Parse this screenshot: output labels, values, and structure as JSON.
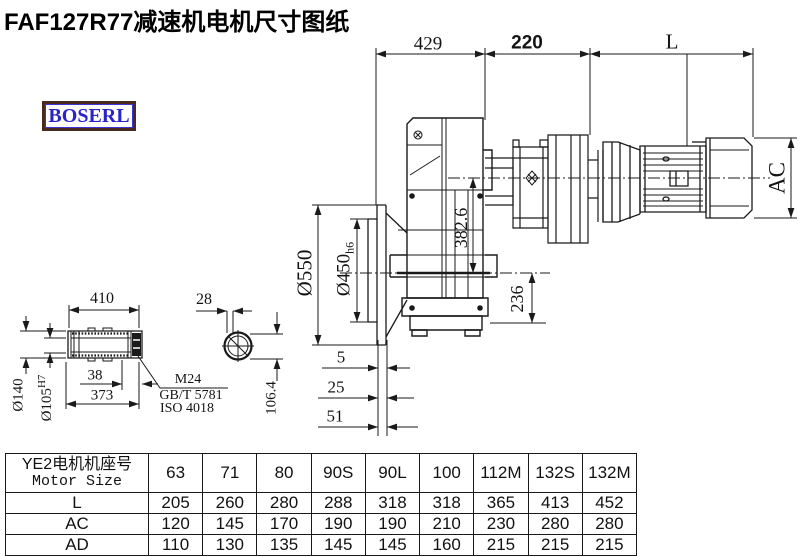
{
  "title": "FAF127R77减速机电机尺寸图纸",
  "logo": "BOSERL",
  "colors": {
    "line": "#1a1a1a",
    "background": "#ffffff",
    "logo_text": "#2a23c8",
    "logo_border": "#4a2a1e"
  },
  "dims": {
    "d429": "429",
    "d220": "220",
    "dL": "L",
    "ac": "AC",
    "dia550": "Ø550",
    "dia450": "Ø450",
    "dia450_tol": "h6",
    "v382": "382.6",
    "v236": "236",
    "b5": "5",
    "b25": "25",
    "b51": "51"
  },
  "shaft": {
    "d410": "410",
    "d28": "28",
    "dia140": "Ø140",
    "dia105": "Ø105",
    "dia105_tol": "H7",
    "d38": "38",
    "d373": "373",
    "callout": [
      "M24",
      "GB/T 5781",
      "ISO 4018"
    ],
    "d106": "106.4"
  },
  "table": {
    "header_cn": "YE2电机机座号",
    "header_en": "Motor Size",
    "columns": [
      "63",
      "71",
      "80",
      "90S",
      "90L",
      "100",
      "112M",
      "132S",
      "132M"
    ],
    "rows": [
      {
        "label": "L",
        "values": [
          "205",
          "260",
          "280",
          "288",
          "318",
          "318",
          "365",
          "413",
          "452"
        ]
      },
      {
        "label": "AC",
        "values": [
          "120",
          "145",
          "170",
          "190",
          "190",
          "210",
          "230",
          "280",
          "280"
        ]
      },
      {
        "label": "AD",
        "values": [
          "110",
          "130",
          "135",
          "145",
          "145",
          "160",
          "215",
          "215",
          "215"
        ]
      }
    ]
  }
}
